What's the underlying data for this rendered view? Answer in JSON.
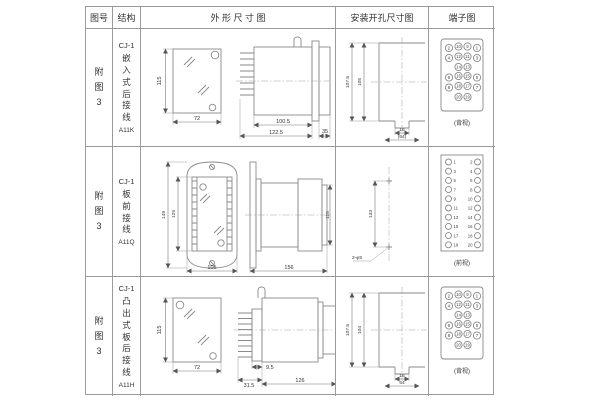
{
  "page": {
    "line_color": "#9a9a9a",
    "drawing_color": "#8a8a8a",
    "background": "#ffffff"
  },
  "header": {
    "figure": "图号",
    "structure": "结构",
    "outline": "外 形 尺 寸 图",
    "mounting": "安装开孔尺寸图",
    "terminal": "端子图"
  },
  "rows": [
    {
      "figure_label": "附图3",
      "model": "CJ-1",
      "structure_text": "嵌入式后接线",
      "code": "A11K",
      "outline": {
        "front_height": "115",
        "front_width": "72",
        "body_length": "100.5",
        "total_length": "122.5",
        "rear_depth": "35"
      },
      "mounting": {
        "outer_height": "107.5",
        "inner_height": "105",
        "slot_width": "16",
        "overall_width": "(64)"
      },
      "terminal": {
        "view_caption": "(背视)",
        "numbers": [
          "2",
          "10",
          "9",
          "1",
          "4",
          "12",
          "11",
          "3",
          "14",
          "13",
          "6",
          "16",
          "15",
          "5",
          "8",
          "18",
          "17",
          "7",
          "20",
          "19"
        ]
      }
    },
    {
      "figure_label": "附图3",
      "model": "CJ-1",
      "structure_text": "板前接线",
      "code": "A11Q",
      "outline": {
        "outer_height": "149",
        "inner_height": "125",
        "front_width": "105",
        "side_length": "156",
        "side_height": "115"
      },
      "mounting": {
        "hole_span": "133",
        "hole_note": "2-φ5"
      },
      "terminal": {
        "view_caption": "(前视)",
        "numbers": [
          "1",
          "2",
          "3",
          "4",
          "5",
          "6",
          "7",
          "8",
          "9",
          "10",
          "11",
          "12",
          "13",
          "14",
          "15",
          "16",
          "17",
          "18",
          "19",
          "20"
        ]
      }
    },
    {
      "figure_label": "附图3",
      "model": "CJ-1",
      "structure_text": "凸出式板后接线",
      "code": "A11H",
      "outline": {
        "front_height": "115",
        "front_width": "72",
        "pin_length": "31.5",
        "gap_length": "9.5",
        "body_length": "126"
      },
      "mounting": {
        "outer_height": "107.5",
        "inner_height": "104",
        "slot_width": "16",
        "overall_width": "64"
      },
      "terminal": {
        "view_caption": "(背视)",
        "numbers": [
          "2",
          "10",
          "9",
          "1",
          "4",
          "12",
          "11",
          "3",
          "14",
          "13",
          "6",
          "16",
          "15",
          "5",
          "8",
          "18",
          "17",
          "7",
          "20",
          "19"
        ]
      }
    }
  ]
}
